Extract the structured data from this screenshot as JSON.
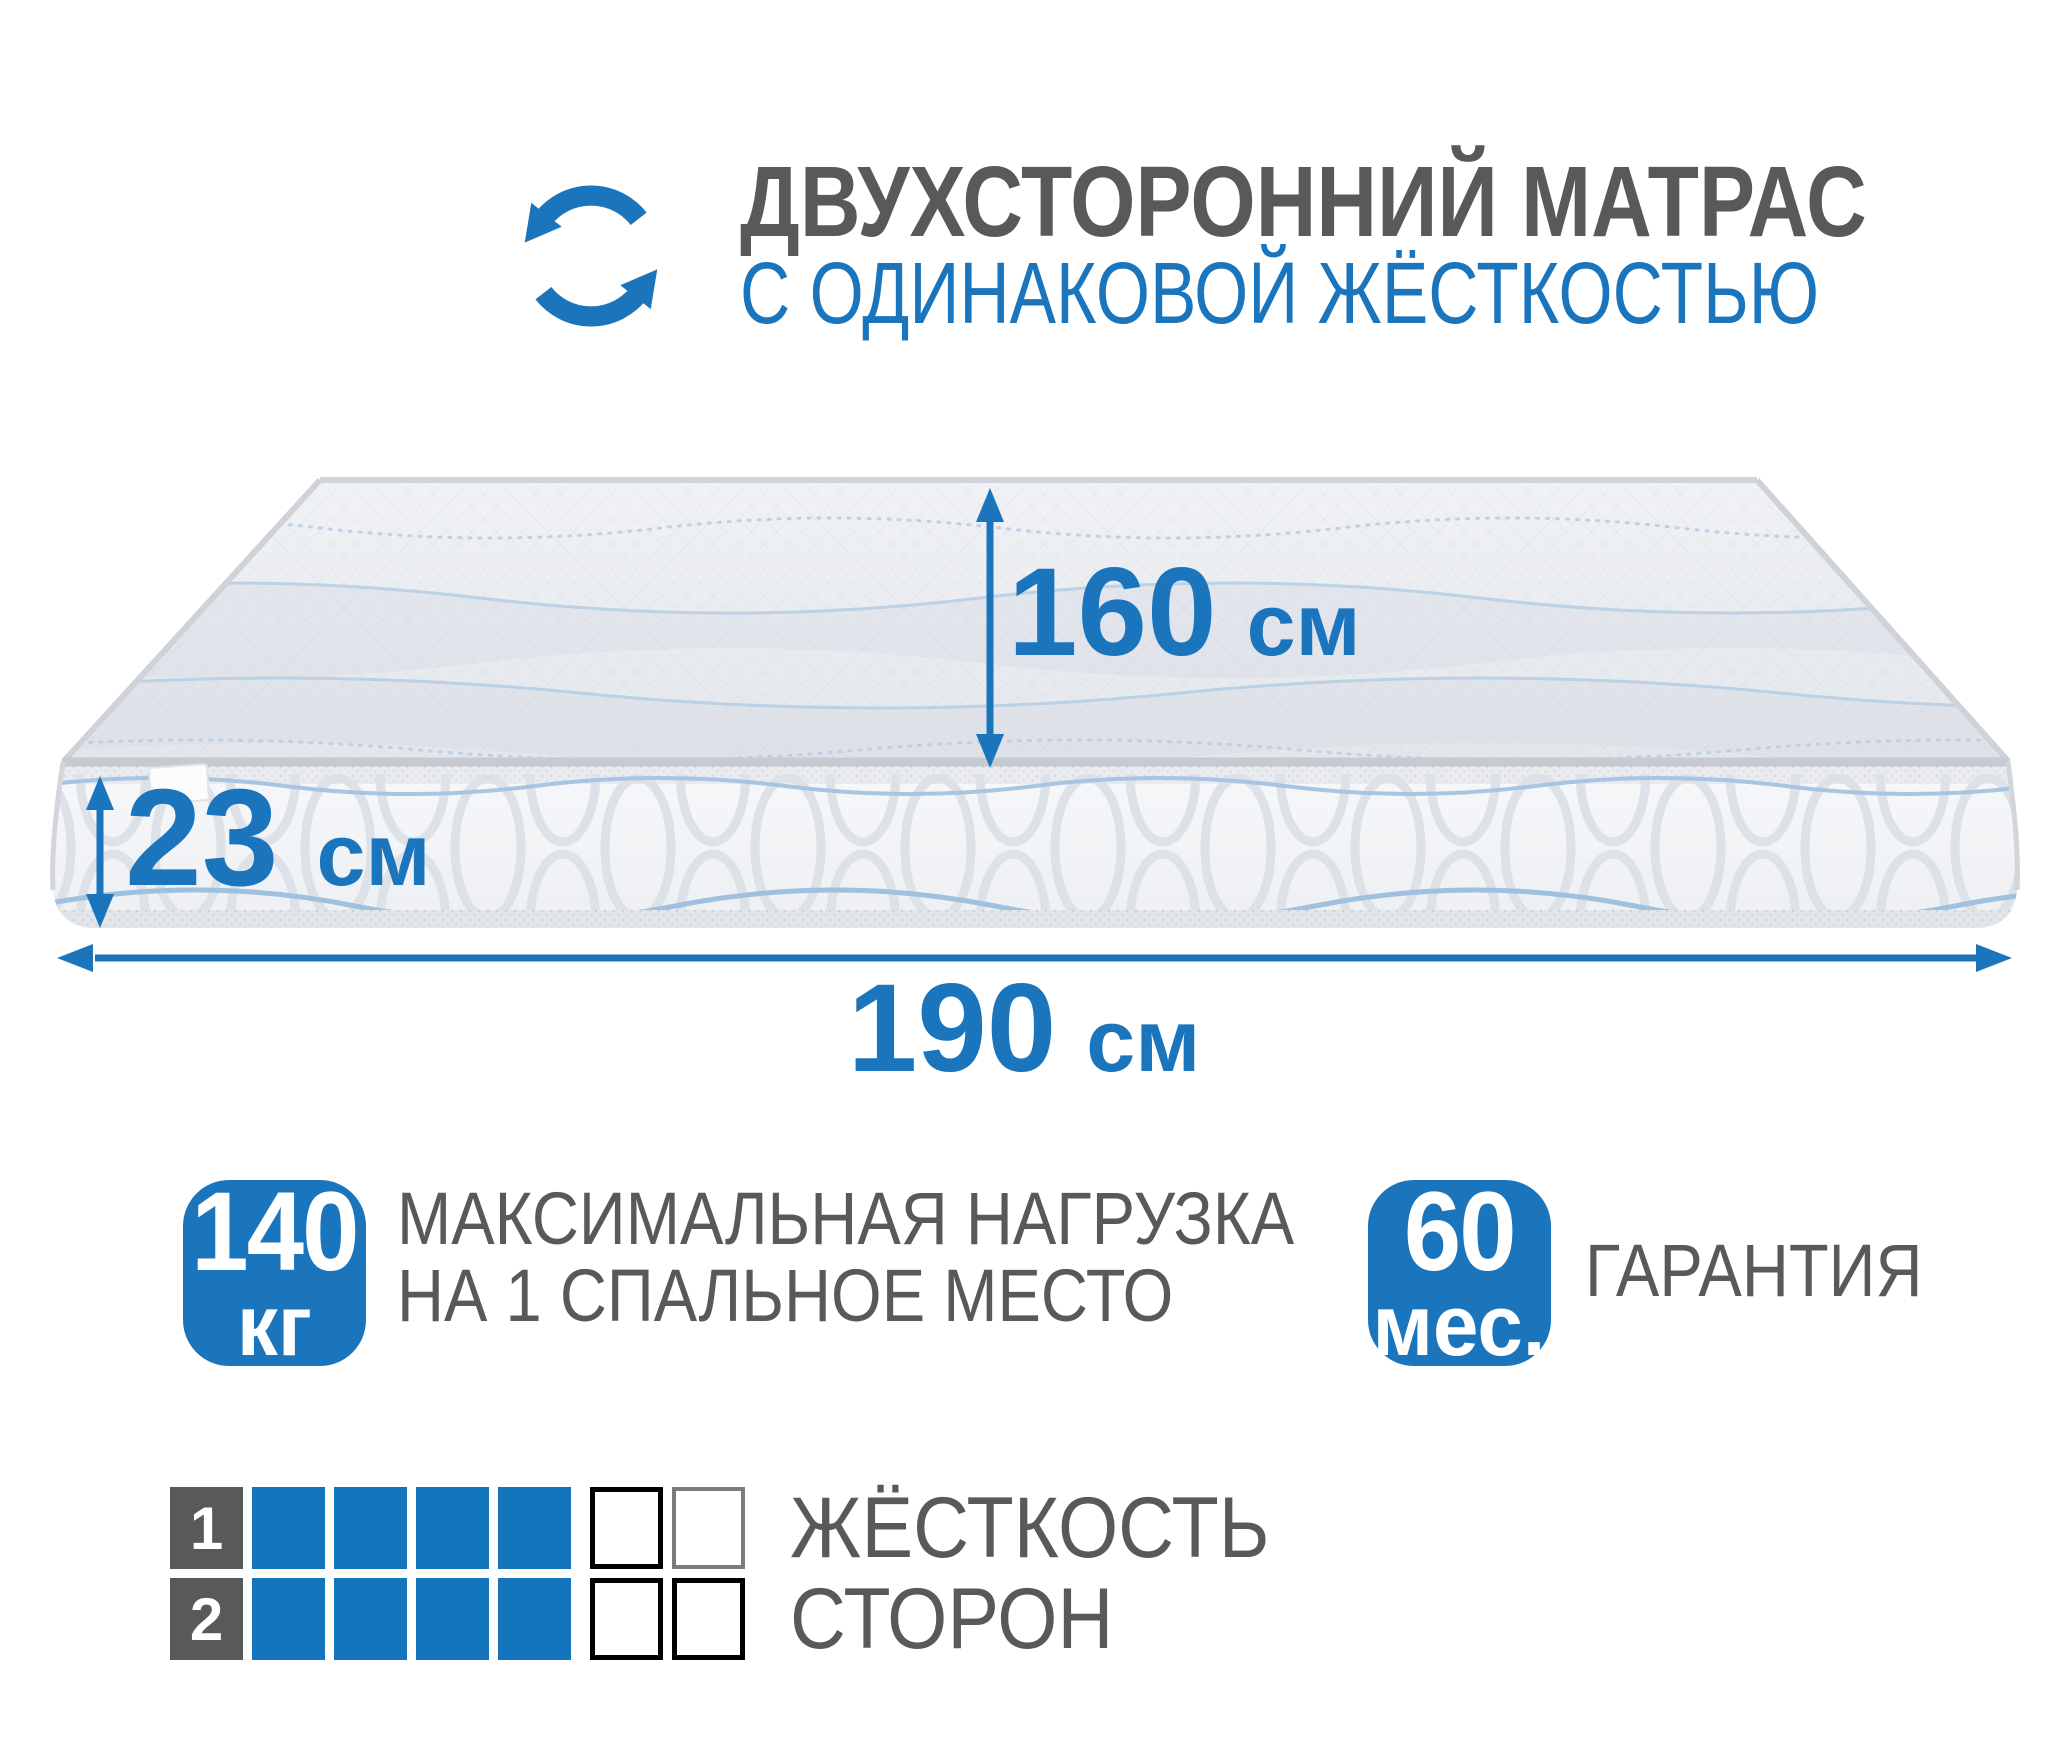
{
  "header": {
    "icon": "rotate-arrows-icon",
    "title_line1": "ДВУХСТОРОННИЙ МАТРАС",
    "title_line2": "С ОДИНАКОВОЙ ЖЁСТКОСТЬЮ"
  },
  "dimensions": {
    "width": {
      "value": "160",
      "unit": "см"
    },
    "height": {
      "value": "23",
      "unit": "см"
    },
    "length": {
      "value": "190",
      "unit": "см"
    }
  },
  "badges": {
    "max_load": {
      "value": "140",
      "unit": "кг",
      "label_line1": "МАКСИМАЛЬНАЯ НАГРУЗКА",
      "label_line2": "НА 1 СПАЛЬНОЕ МЕСТО"
    },
    "warranty": {
      "value": "60",
      "unit": "мес.",
      "label": "ГАРАНТИЯ"
    }
  },
  "firmness": {
    "label_line1": "ЖЁСТКОСТЬ",
    "label_line2": "СТОРОН",
    "rows": [
      {
        "num": "1",
        "filled": 4,
        "total": 6
      },
      {
        "num": "2",
        "filled": 4,
        "total": 6
      }
    ]
  },
  "colors": {
    "accent": "#1B75BC",
    "square_blue": "#1474BC",
    "gray": "#58595B"
  }
}
